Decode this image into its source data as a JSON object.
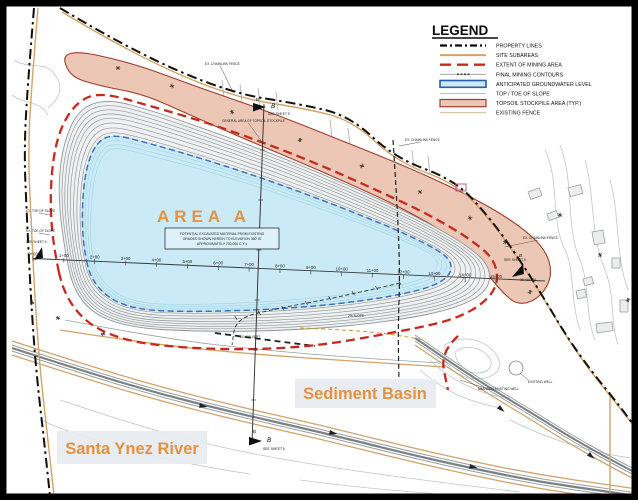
{
  "legend": {
    "title": "LEGEND",
    "items": [
      {
        "key": "property_lines",
        "label": "PROPERTY LINES"
      },
      {
        "key": "site_subareas",
        "label": "SITE SUBAREAS"
      },
      {
        "key": "extent_mining",
        "label": "EXTENT OF MINING AREA"
      },
      {
        "key": "final_contours",
        "label": "FINAL MINING CONTOURS"
      },
      {
        "key": "groundwater",
        "label": "ANTICIPATED GROUNDWATER LEVEL"
      },
      {
        "key": "top_toe",
        "label": "TOP / TOE OF SLOPE"
      },
      {
        "key": "topsoil",
        "label": "TOPSOIL STOCKPILE AREA (TYP.)"
      },
      {
        "key": "existing_fence",
        "label": "EXISTING FENCE"
      }
    ]
  },
  "area_label": "AREA  A",
  "sediment_basin_label": "Sediment Basin",
  "river_label": "Santa Ynez River",
  "marker": {
    "letter": "B",
    "see_sheet": "SEE SHEET 5"
  },
  "stations": [
    "0+00",
    "1+00",
    "2+00",
    "3+00",
    "4+00",
    "5+00",
    "6+00",
    "7+00",
    "8+00",
    "9+00",
    "10+00",
    "11+00",
    "12+00",
    "13+00",
    "14+00",
    "15+00"
  ],
  "station_end": "15+00+38",
  "note": {
    "l1": "POTENTIAL EXCAVATED MATERIAL FROM EXISTING",
    "l2": "GRADES SHOWN HEREIN TO ELEVATION 360' IS",
    "l3": "APPROXIMATELY 700,000 C.Y.±"
  },
  "annotations": {
    "fence": "EX. CHAINLINK FENCE",
    "topsoil_general": "GENERAL AREA OF TOPSOIL STOCKPILE",
    "existing_well": "EXISTING WELL",
    "abandon_well": "ABANDON EXISTING WELL",
    "slope_top": "EX. TOP OF SLOPE",
    "slope_toe": "EX. TOE OF SLOPE",
    "slope_pct": "2% SLOPE",
    "culvert": "24\" CULVERT"
  },
  "colors": {
    "accent_orange": "#E5913F",
    "topsoil_fill": "#EDC7B5",
    "topsoil_edge": "#A33B2B",
    "mining_red": "#C9291D",
    "water_fill": "#C9EAF6",
    "groundwater_blue": "#3A6FC0",
    "subarea_tan": "#D2A368",
    "contour_gray": "#8F9698",
    "property_black": "#141008"
  }
}
